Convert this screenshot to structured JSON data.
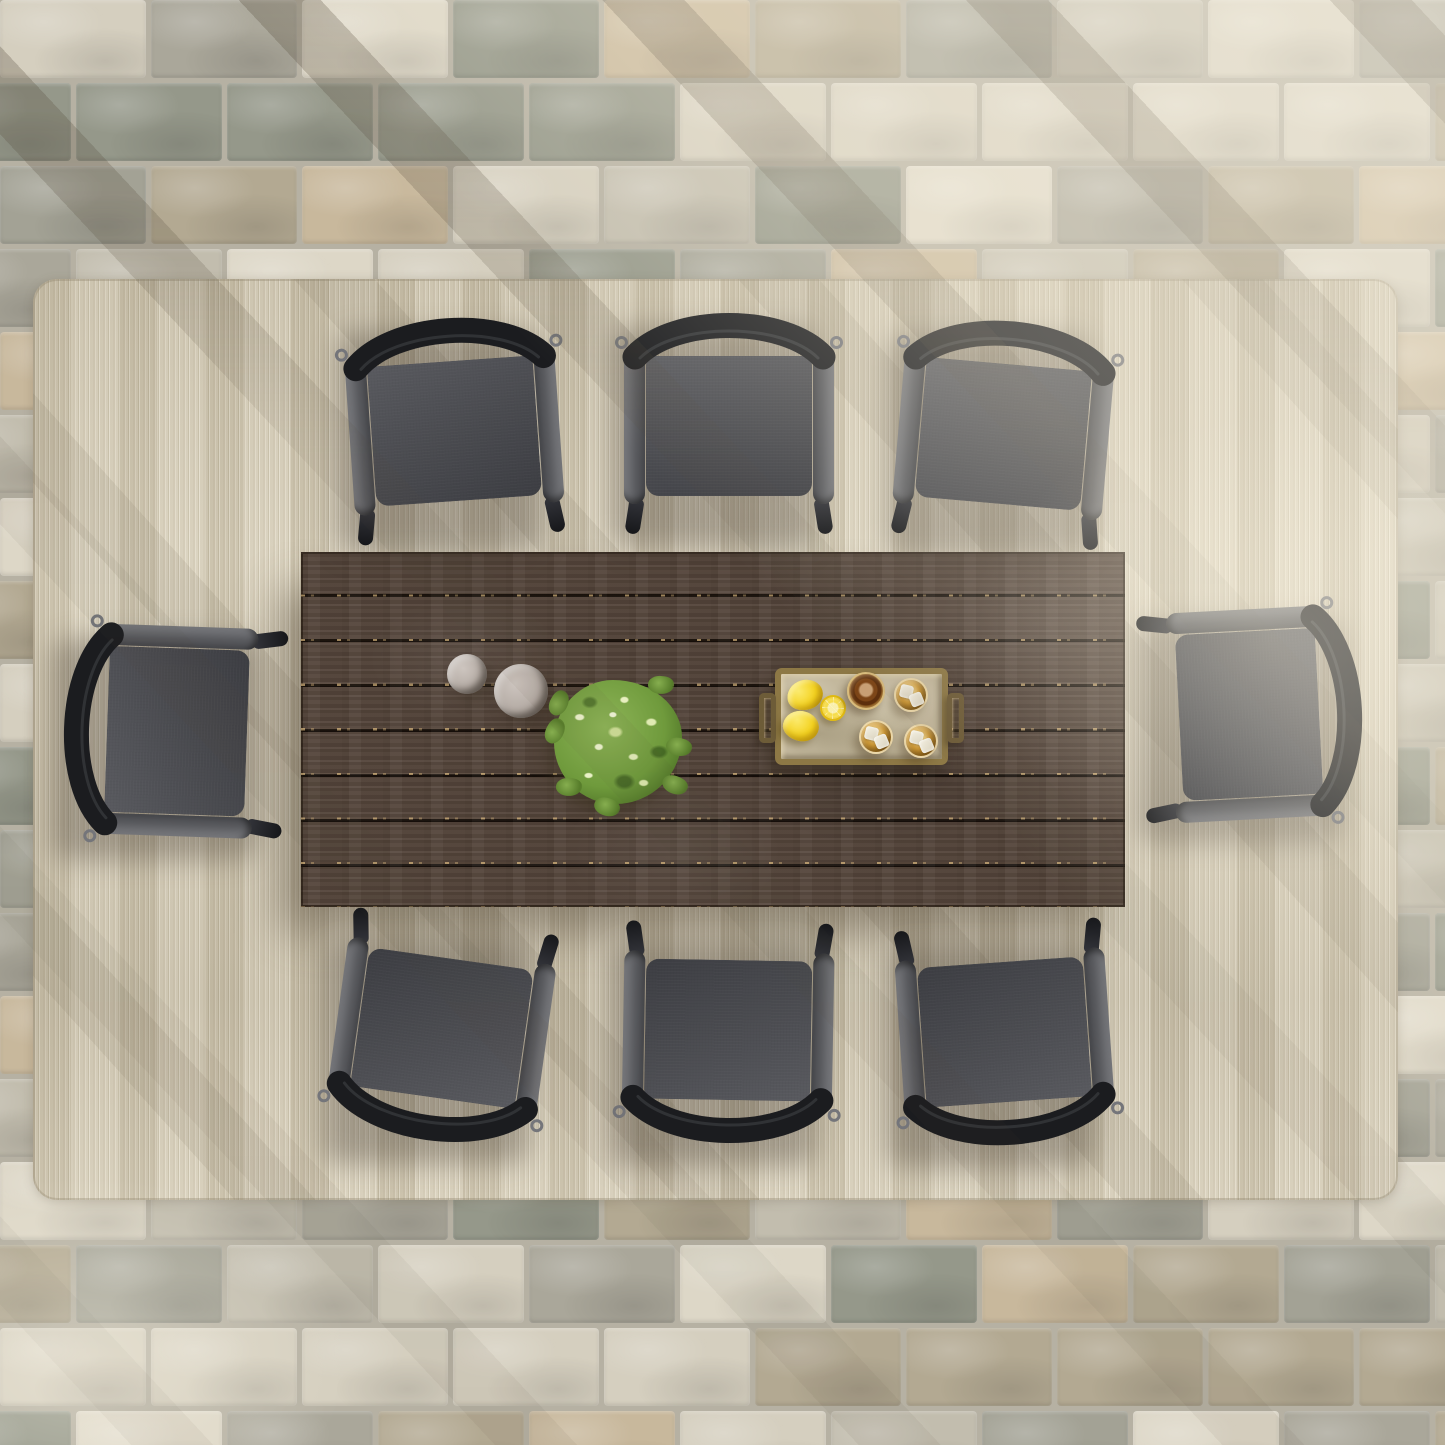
{
  "scene": {
    "description": "Top-down view of an outdoor dining set: rectangular dark-brown wood plank table with eight black-framed chairs with dark gray cushions, on a striated beige area rug over mixed beige-gray stone paver bricks, with diagonal sunlight and shadow stripes",
    "canvas": {
      "width": 1445,
      "height": 1445
    }
  },
  "palette": {
    "paving_grout": "#b6b1a3",
    "rug_base": "#d6cdb7",
    "table_wood": "#54443a",
    "table_plank_gap": "#241a13",
    "chair_backrest": "#1b1c1f",
    "chair_frame": "#5a5b5f",
    "chair_cushion": "#4a4b50",
    "tray_brass": "#8d7845",
    "tray_surface": "#c3b89d",
    "lemon_yellow": "#f4d21f",
    "plant_green": "#6f9a3c",
    "drink_amber": "#b97f2a",
    "cylinder_gray": "#b4aba4"
  },
  "paving": {
    "rows": 18,
    "cols": 11,
    "brick_width": 146,
    "brick_height": 78,
    "gap": 5,
    "row_offset": 75,
    "palette": [
      "#d5cfbf",
      "#c2bdae",
      "#a3a295",
      "#b3a992",
      "#c8b89c",
      "#95988a",
      "#ddd7c7",
      "#aaa79a"
    ]
  },
  "rug": {
    "x": 33,
    "y": 279,
    "width": 1365,
    "height": 921
  },
  "table": {
    "x": 301,
    "y": 552,
    "width": 824,
    "height": 355,
    "planks": 8
  },
  "chairs": [
    {
      "id": "top-left",
      "cx": 454,
      "cy": 424,
      "rotation": -4
    },
    {
      "id": "top-middle",
      "cx": 729,
      "cy": 419,
      "rotation": 0
    },
    {
      "id": "top-right",
      "cx": 1004,
      "cy": 427,
      "rotation": 5
    },
    {
      "id": "left-head",
      "cx": 170,
      "cy": 731,
      "rotation": -88
    },
    {
      "id": "right-head",
      "cx": 1256,
      "cy": 714,
      "rotation": 87
    },
    {
      "id": "bottom-left",
      "cx": 441,
      "cy": 1035,
      "rotation": 188
    },
    {
      "id": "bottom-middle",
      "cx": 728,
      "cy": 1037,
      "rotation": 181
    },
    {
      "id": "bottom-right",
      "cx": 1005,
      "cy": 1039,
      "rotation": 176
    }
  ],
  "tabletop_items": {
    "cylinders": [
      {
        "cx": 467,
        "cy": 674,
        "r": 20
      },
      {
        "cx": 521,
        "cy": 691,
        "r": 27
      }
    ],
    "plant": {
      "cx": 618,
      "cy": 748,
      "box": 136
    },
    "tray": {
      "x": 775,
      "y": 668,
      "width": 173,
      "height": 97,
      "lemons": [
        {
          "cx": 805,
          "cy": 695,
          "rx": 18,
          "ry": 15,
          "tilt": -15
        },
        {
          "cx": 801,
          "cy": 726,
          "rx": 18,
          "ry": 15,
          "tilt": 12
        }
      ],
      "lemon_half": {
        "cx": 833,
        "cy": 708,
        "r": 13
      },
      "carafe": {
        "cx": 866,
        "cy": 691,
        "r": 19
      },
      "glasses": [
        {
          "cx": 911,
          "cy": 695,
          "r": 17
        },
        {
          "cx": 876,
          "cy": 737,
          "r": 17
        },
        {
          "cx": 921,
          "cy": 741,
          "r": 17
        }
      ]
    }
  }
}
